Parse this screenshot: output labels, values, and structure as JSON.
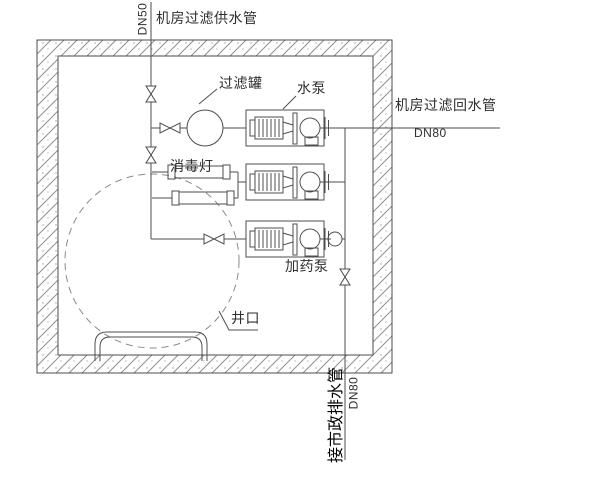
{
  "title": "泳池机房过滤管道布置图",
  "pipes": {
    "supply": {
      "label": "机房过滤供水管",
      "dn": "DN50"
    },
    "return": {
      "label": "机房过滤回水管",
      "dn": "DN80"
    },
    "drain": {
      "label": "接市政排水管",
      "dn": "DN80"
    }
  },
  "equipment": {
    "filter_tank": "过滤罐",
    "water_pump": "水泵",
    "uv_lamp": "消毒灯",
    "dosing_pump": "加药泵",
    "well_mouth": "井口"
  },
  "counts": {
    "pumps": 3,
    "uv_lamps": 2,
    "valves": 5
  },
  "colors": {
    "line": "#4d4d4d",
    "hatch": "#8f8f8f",
    "dashed": "#8a8a8a",
    "text": "#2e2e2e",
    "background": "#ffffff"
  }
}
